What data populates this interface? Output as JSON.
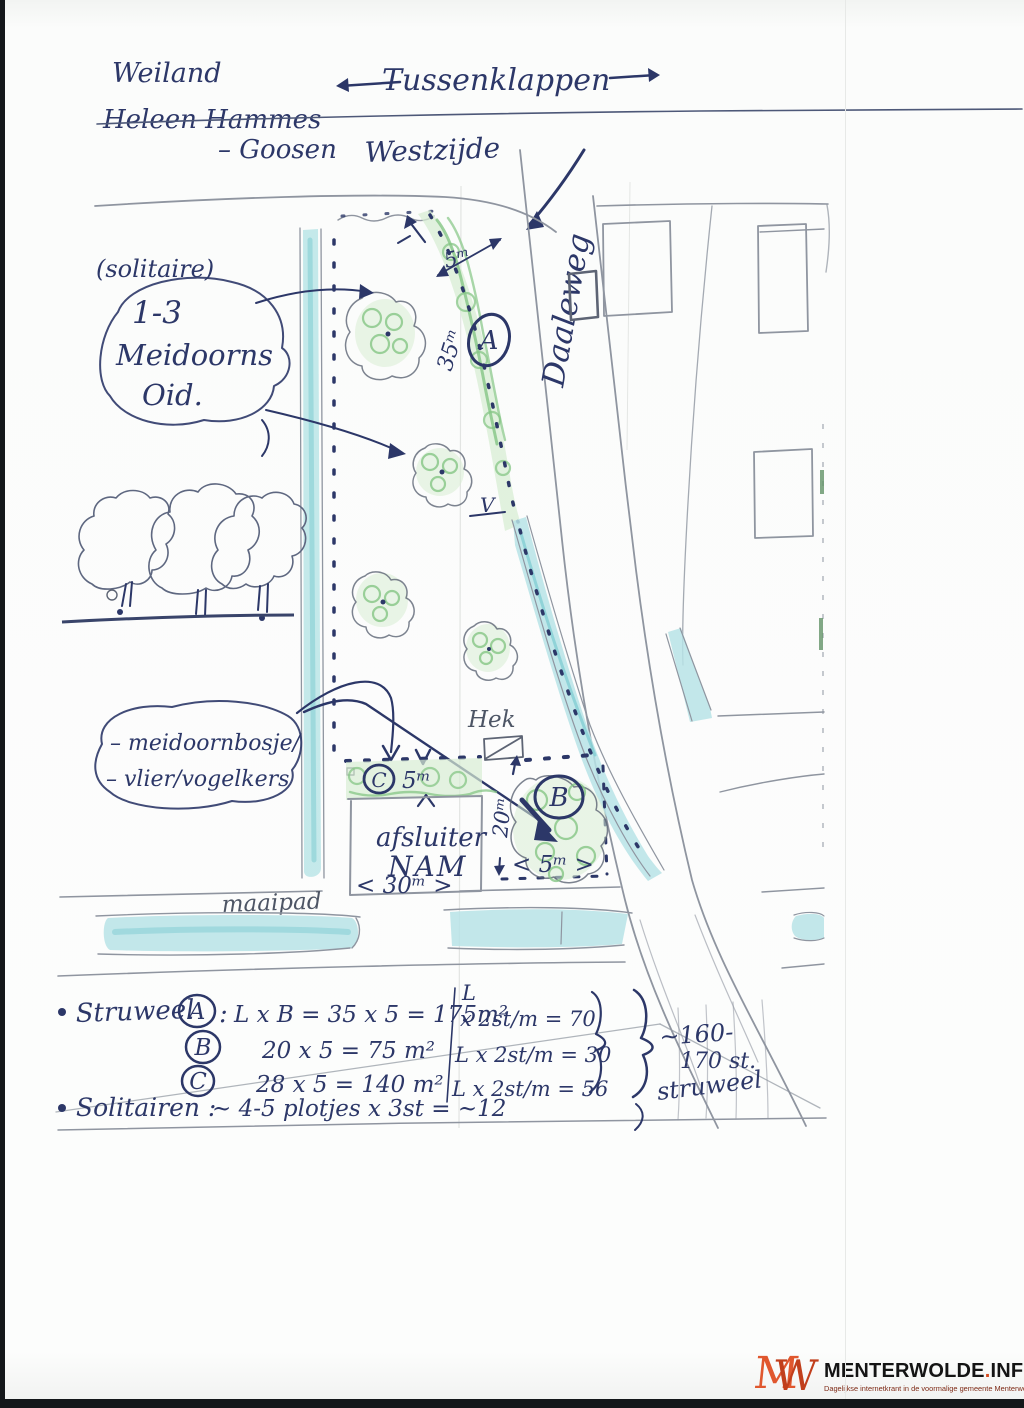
{
  "colors": {
    "ink_blue": "#2c3768",
    "pencil_gray": "#8f95a0",
    "crayon_green": "#85c685",
    "crayon_cyan": "#b7e3e6",
    "logo_orange": "#e0572e",
    "tagline_red": "#7e2a16"
  },
  "header": {
    "field_label": "Weiland",
    "owner_name_struck": "Heleen Hammes",
    "owner_name_suffix": "– Goosen",
    "place_name": "Tussenklappen",
    "side_label": "Westzijde",
    "road_name": "Daaleweg"
  },
  "bubbles": {
    "solitaire_note": "(solitaire)",
    "meidoorn": {
      "line1": "1-3",
      "line2": "Meidoorns",
      "line3": "Oid."
    },
    "bosje": {
      "line1": "– meidoornbosje/",
      "line2": "– vlier/vogelkers"
    }
  },
  "map_labels": {
    "hek": "Hek",
    "afsluiter_line1": "afsluiter",
    "afsluiter_line2": "NAM",
    "maaipad": "maaipad",
    "marker_a": "A",
    "marker_b": "B",
    "marker_c": "C",
    "v_mark": "V"
  },
  "measurements": {
    "strip_a_width": "5ᵐ",
    "strip_a_length": "35ᵐ",
    "strip_c_width": "5ᵐ",
    "strip_b_length": "20ᵐ",
    "strip_b_width": "< 5ᵐ >",
    "nam_width": "< 30ᵐ >"
  },
  "calculations": {
    "struweel_label": "Struweel",
    "row_a": {
      "marker": "A",
      "colon": ":",
      "formula": "L x B = 35 x 5 = 175m²",
      "unit_top": "L",
      "unit_formula": "x 2st/m = 70"
    },
    "row_b": {
      "marker": "B",
      "formula": "20 x 5 =  75 m²",
      "unit_formula": "L x 2st/m = 30"
    },
    "row_c": {
      "marker": "C",
      "formula": "28 x 5 = 140 m²",
      "unit_formula": "L x 2st/m = 56"
    },
    "solitairen_label": "Solitairen :",
    "solitairen_formula": "~ 4-5 plotjes x 3st  =  ~12",
    "total_line1": "~160-",
    "total_line2": "170 st.",
    "total_line3": "struweel"
  },
  "watermark": {
    "logo_m": "M",
    "logo_w": "W",
    "site_name": "MENTERWOLDE",
    "site_dot": ".",
    "site_tld": "INFO",
    "tagline": "Dagelijkse internetkrant in de voormalige gemeente Menterwolde e.o."
  }
}
